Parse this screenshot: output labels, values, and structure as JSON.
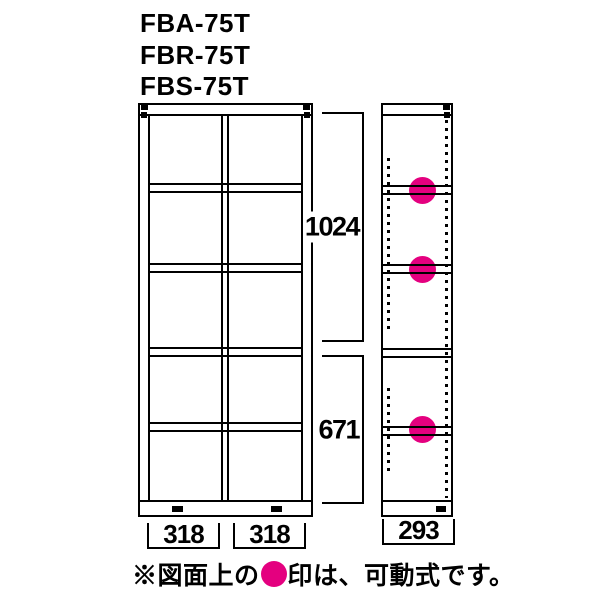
{
  "colors": {
    "line": "#000000",
    "pink": "#e4007f",
    "bg": "#ffffff"
  },
  "header": {
    "models": [
      "FBA-75T",
      "FBR-75T",
      "FBS-75T"
    ]
  },
  "dimensions": {
    "upper_section_height": "1024",
    "lower_section_height": "671",
    "front_left_width": "318",
    "front_right_width": "318",
    "side_depth": "293"
  },
  "front_view": {
    "columns": 2,
    "rows": 5
  },
  "side_view": {
    "shelves": [
      {
        "movable": true
      },
      {
        "movable": true
      },
      {
        "movable": false
      },
      {
        "movable": true
      }
    ]
  },
  "note": {
    "prefix": "※図面上の",
    "dot": "●",
    "suffix": "印は、可動式です。"
  }
}
